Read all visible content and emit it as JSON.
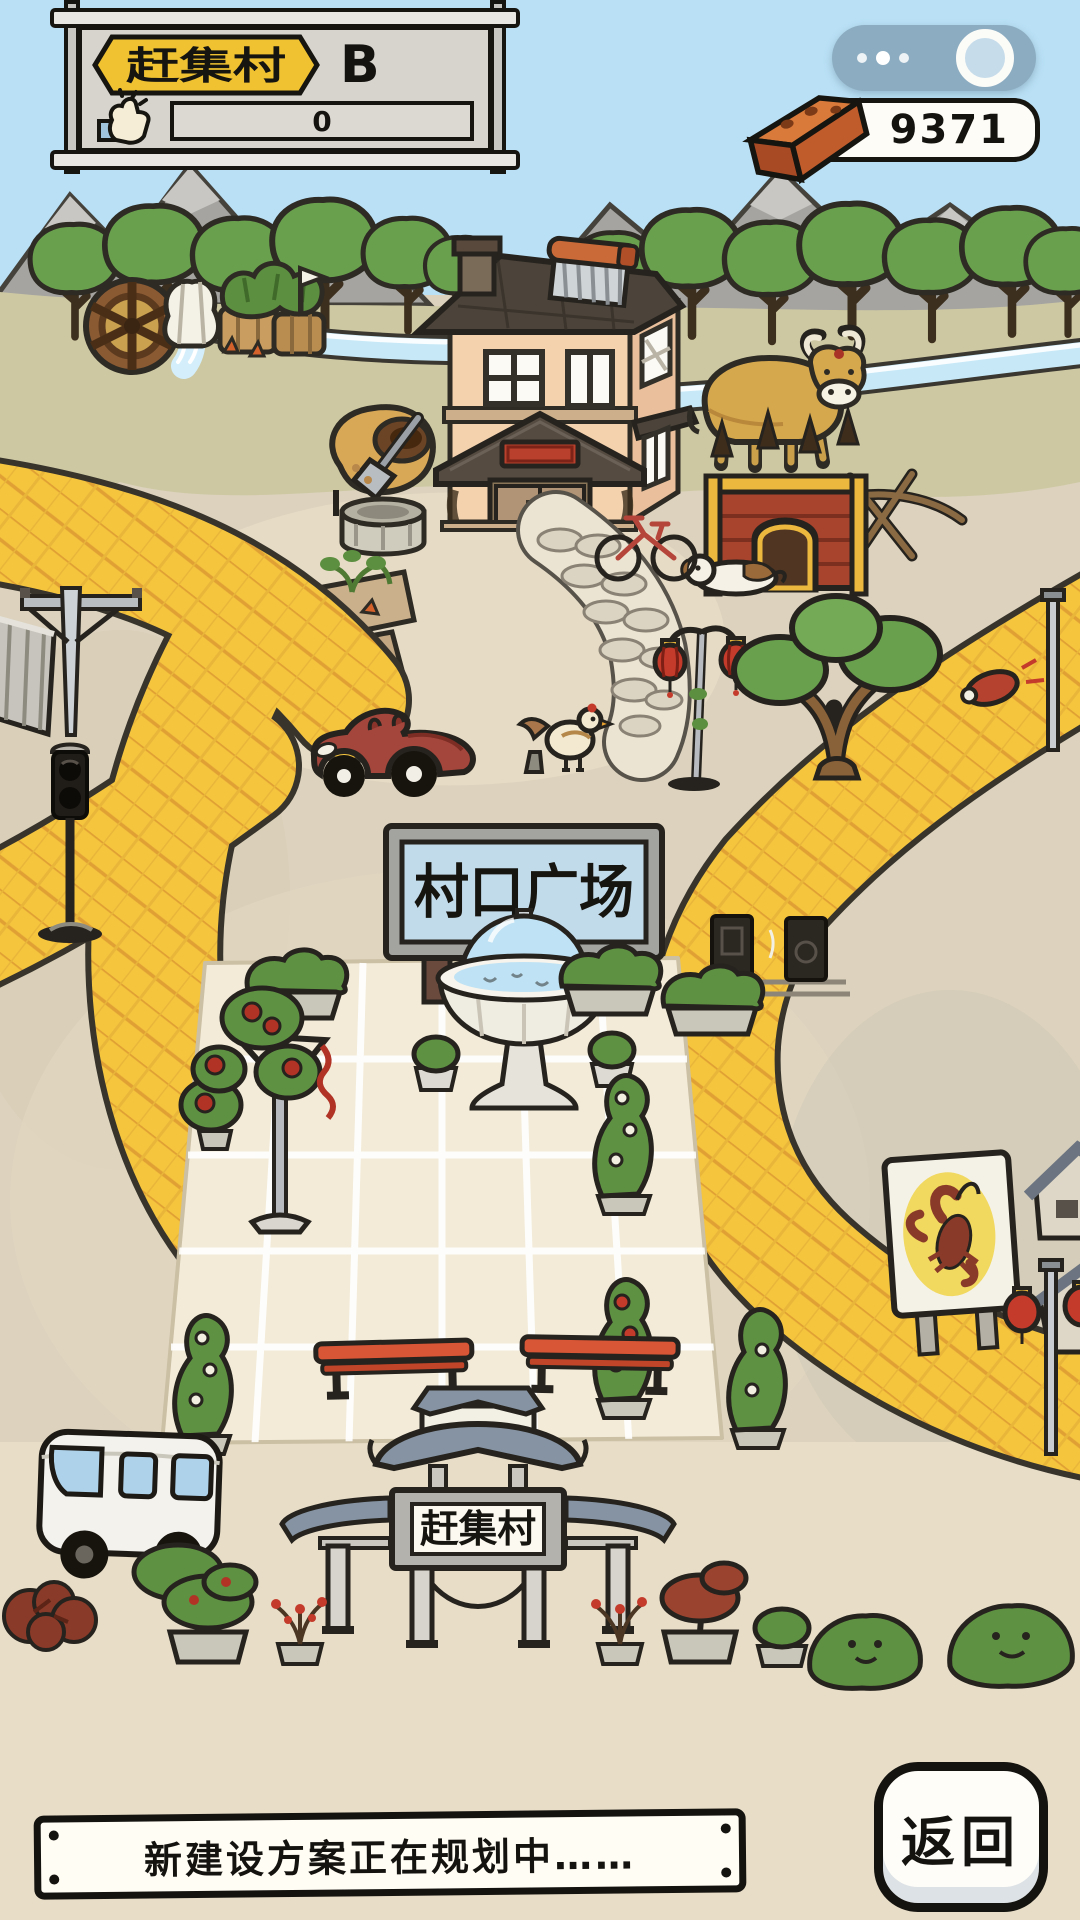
{
  "hud": {
    "village_name": "赶集村",
    "grade": "B",
    "like_count": "0",
    "brick_count": "9371",
    "icons": {
      "like": "thumbs-up-icon",
      "brick": "brick-icon",
      "more": "more-dots-icon",
      "capsule_circle": "capsule-circle-icon"
    },
    "colors": {
      "banner_yellow": "#F0C231",
      "board_gray": "#D6D4CD",
      "capsule_blue": "#8CADC1"
    }
  },
  "scene": {
    "plaza_sign_label": "村口广场",
    "gate_sign_label": "赶集村",
    "landmarks": [
      "mountains",
      "trees",
      "river",
      "water-wheel",
      "farm-house",
      "vegetable-garden",
      "cow",
      "dog-house",
      "fence",
      "dog",
      "bicycle",
      "dirt-mound-with-shovel",
      "well",
      "garden-plots",
      "street-lamp-with-lanterns",
      "big-tree",
      "red-car",
      "chicken",
      "traffic-light",
      "power-pole",
      "plaza",
      "fountain",
      "basketball-hoop",
      "benches",
      "speakers",
      "hedge-planters",
      "crayfish-billboard",
      "red-lanterns",
      "village-gate",
      "minibus",
      "bonsai-pots",
      "bushes"
    ],
    "colors": {
      "road_yellow": "#F5C53E",
      "sky_blue": "#B9E0F5",
      "ground_tan": "#DCD2BD",
      "plaza_cream": "#F3EBD8"
    }
  },
  "footer": {
    "notice_text": "新建设方案正在规划中……",
    "back_label": "返回"
  }
}
